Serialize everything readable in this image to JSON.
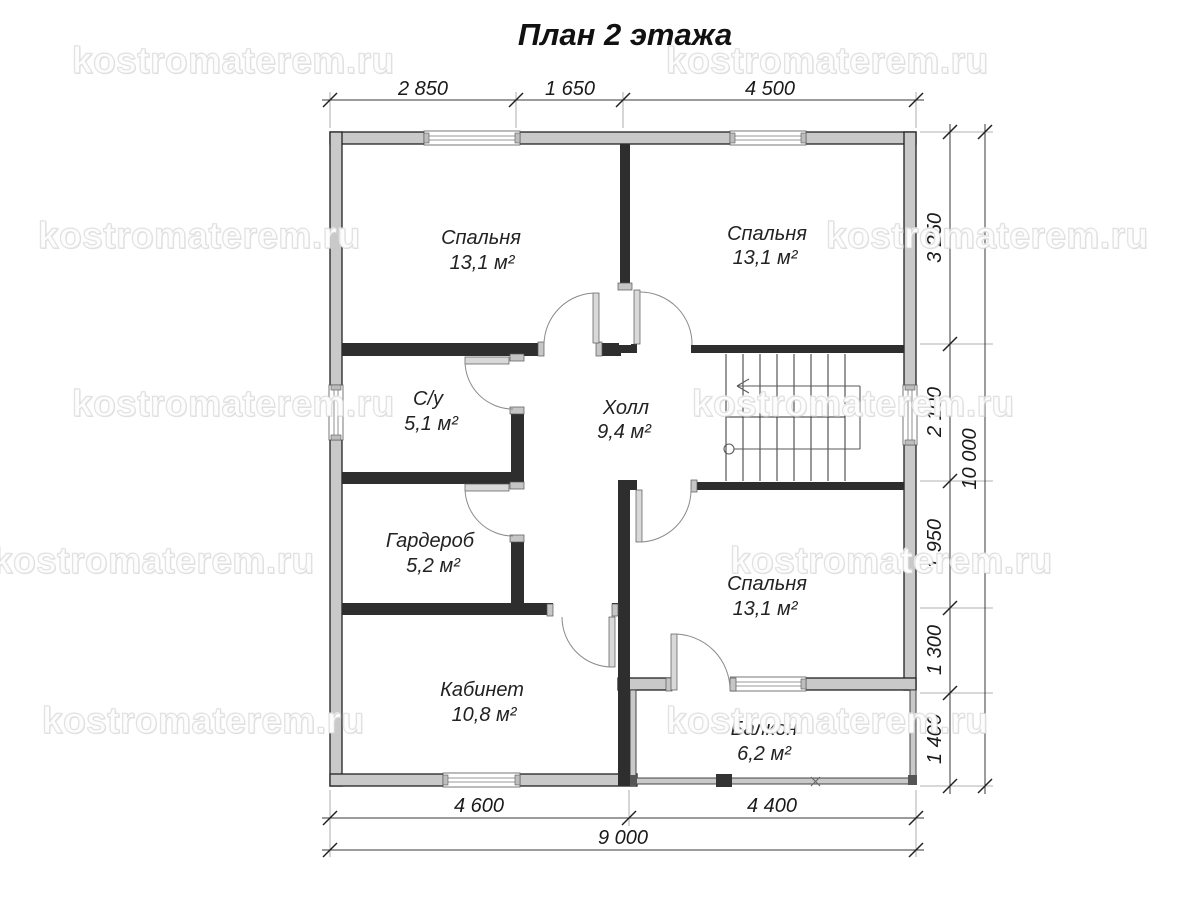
{
  "title": "План 2 этажа",
  "watermark": {
    "text": "kostromaterem.ru"
  },
  "rooms": {
    "bedroom1": {
      "name": "Спальня",
      "area": "13,1 м²"
    },
    "bedroom2": {
      "name": "Спальня",
      "area": "13,1 м²"
    },
    "bathroom": {
      "name": "С/у",
      "area": "5,1 м²"
    },
    "hall": {
      "name": "Холл",
      "area": "9,4 м²"
    },
    "wardrobe": {
      "name": "Гардероб",
      "area": "5,2 м²"
    },
    "bedroom3": {
      "name": "Спальня",
      "area": "13,1 м²"
    },
    "office": {
      "name": "Кабинет",
      "area": "10,8 м²"
    },
    "balcony": {
      "name": "Балкон",
      "area": "6,2 м²"
    }
  },
  "dimensions": {
    "top": [
      "2 850",
      "1 650",
      "4 500"
    ],
    "right": [
      "3 250",
      "2 100",
      "1 950",
      "1 300",
      "1 400"
    ],
    "right_total": "10 000",
    "bottom": [
      "4 600",
      "4 400"
    ],
    "bottom_total": "9 000"
  }
}
